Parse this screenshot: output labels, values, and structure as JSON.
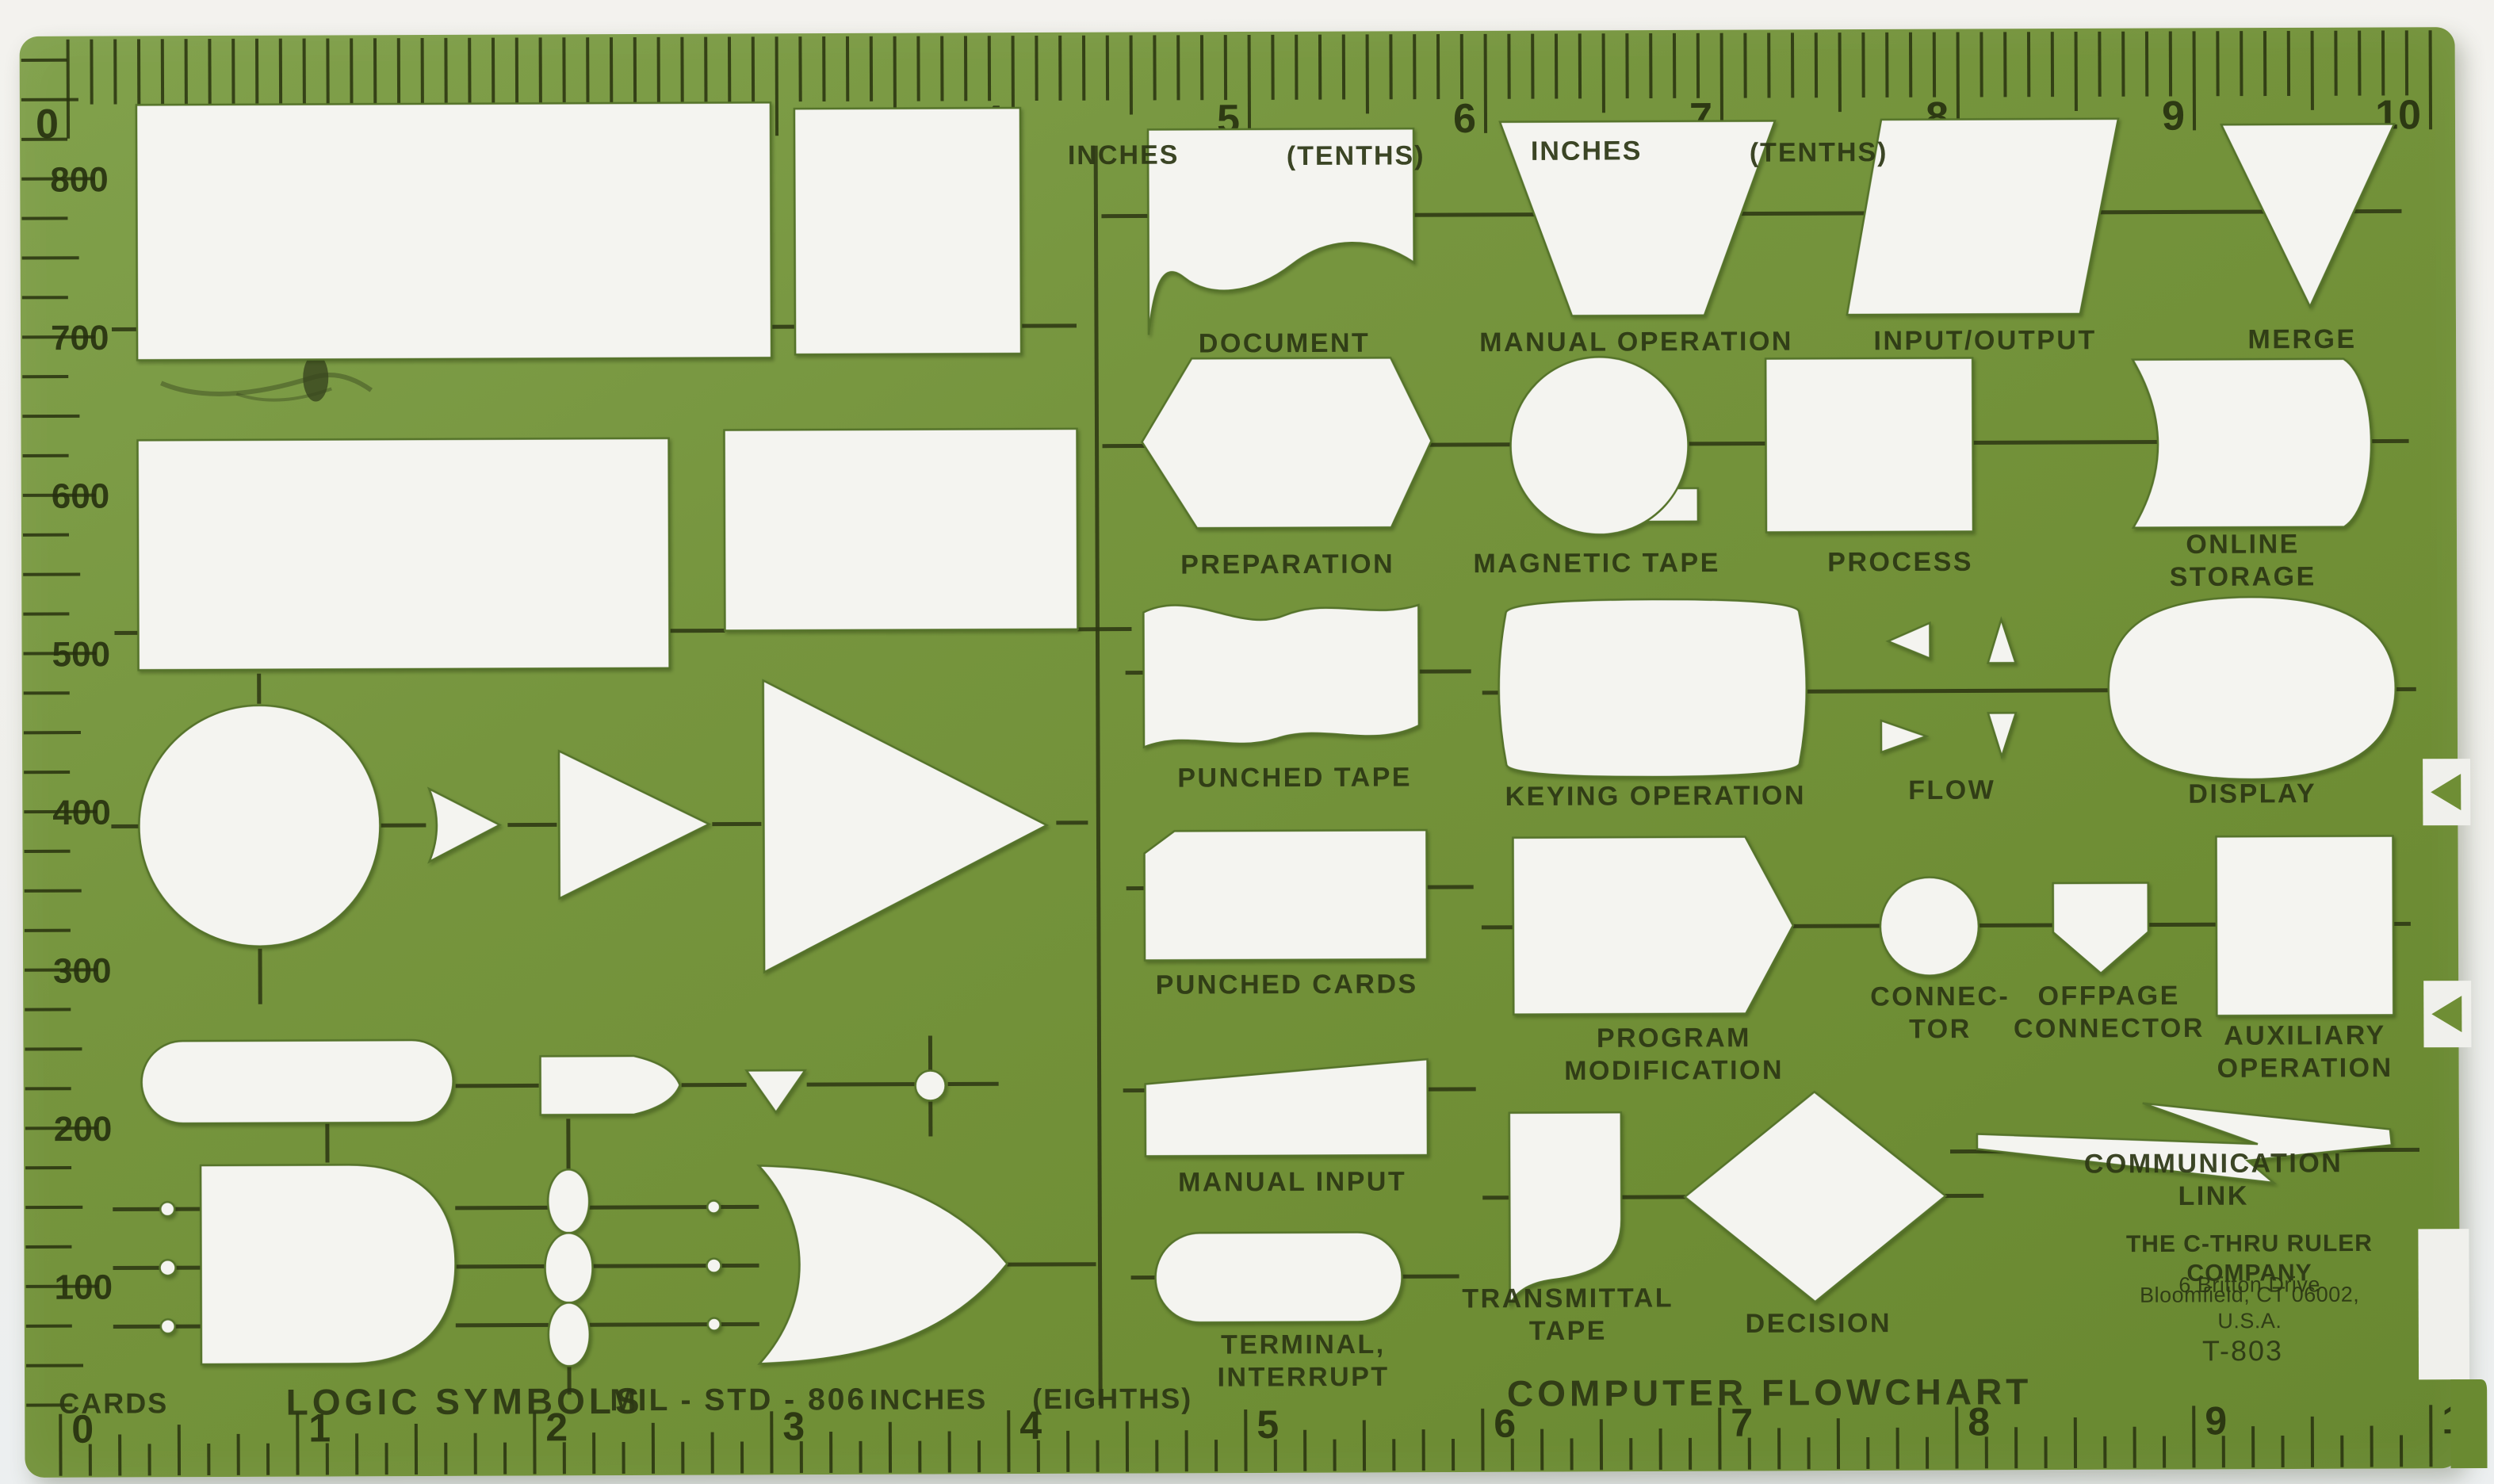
{
  "colors": {
    "template_green": "#6f8e35",
    "ink": "#2d3813",
    "cutout_white": "#f4f4f0",
    "scan_background": "#f1f1ed"
  },
  "rulers": {
    "top": {
      "numbers": [
        "0",
        "1",
        "2",
        "3",
        "4",
        "5",
        "6",
        "7",
        "8",
        "9",
        "10"
      ],
      "unit_labels": [
        "INCHES",
        "(TENTHS)",
        "INCHES",
        "(TENTHS)"
      ]
    },
    "bottom": {
      "numbers": [
        "0",
        "1",
        "2",
        "3",
        "4",
        "5",
        "6",
        "7",
        "8",
        "9",
        "10"
      ]
    },
    "left": {
      "numbers": [
        "800",
        "700",
        "600",
        "500",
        "400",
        "300",
        "200",
        "100"
      ],
      "caption": "CARDS"
    }
  },
  "sections": {
    "left_caption": "LOGIC SYMBOLS",
    "left_standard": "MIL - STD - 806",
    "left_units": "INCHES",
    "left_units_sub": "(EIGHTHS)",
    "right_caption": "COMPUTER FLOWCHART"
  },
  "labels": {
    "document": "DOCUMENT",
    "manual_operation": "MANUAL OPERATION",
    "input_output": "INPUT/OUTPUT",
    "merge": "MERGE",
    "preparation": "PREPARATION",
    "magnetic_tape": "MAGNETIC TAPE",
    "process": "PROCESS",
    "online_storage": "ONLINE STORAGE",
    "punched_tape": "PUNCHED TAPE",
    "keying_operation": "KEYING OPERATION",
    "flow": "FLOW",
    "display": "DISPLAY",
    "punched_cards": "PUNCHED CARDS",
    "program_modification": "PROGRAM\nMODIFICATION",
    "connector": "CONNEC-\nTOR",
    "offpage_connector": "OFFPAGE\nCONNECTOR",
    "auxiliary_operation": "AUXILIARY\nOPERATION",
    "manual_input": "MANUAL INPUT",
    "transmittal_tape": "TRANSMITTAL\nTAPE",
    "decision": "DECISION",
    "communication_link": "COMMUNICATION LINK",
    "terminal_interrupt": "TERMINAL,\nINTERRUPT"
  },
  "title_block": {
    "company": "THE C-THRU RULER COMPANY",
    "address_line1": "6 Britton Drive",
    "address_line2": "Bloomfield, CT 06002, U.S.A.",
    "model": "T-803"
  }
}
